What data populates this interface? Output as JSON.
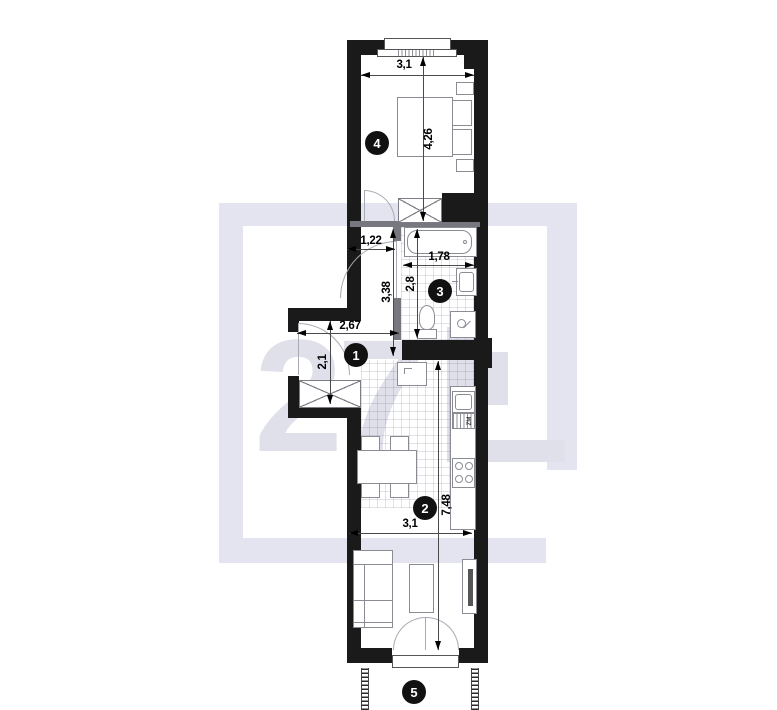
{
  "watermark": {
    "text": "27"
  },
  "rooms": {
    "r1": "1",
    "r2": "2",
    "r3": "3",
    "r4": "4",
    "r5": "5"
  },
  "dims": {
    "top_width": "3,1",
    "bedroom_height": "4,26",
    "corridor_width": "1,22",
    "bath_width": "1,78",
    "bath_height": "2,8",
    "hall_height": "3,38",
    "hall_width": "2,67",
    "niche_height": "2,1",
    "living_height": "7,48",
    "living_width": "3,1"
  },
  "labels": {
    "dishwasher": "ZM"
  },
  "colors": {
    "wall": "#1a1a1a",
    "partition": "#77777f",
    "furniture_line": "#8b8b94",
    "watermark_frame": "#e3e4ef",
    "watermark_glyph": "#dfe0ea",
    "badge": "#111111"
  }
}
